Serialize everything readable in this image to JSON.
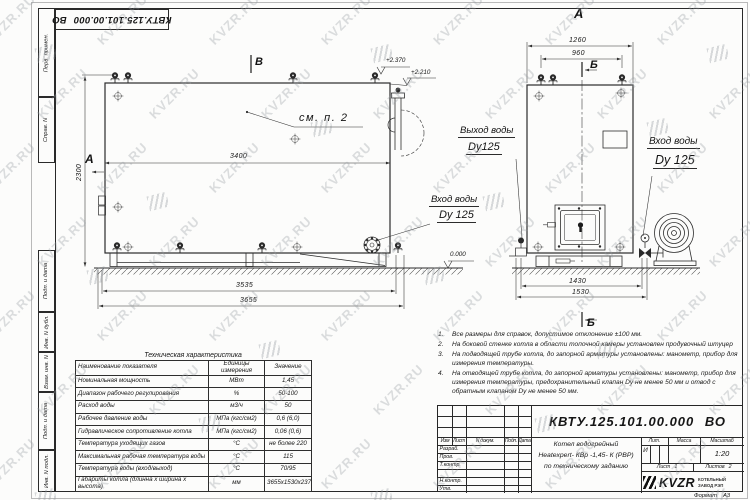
{
  "watermark": {
    "text": "KVZR.RU"
  },
  "stamp_top": {
    "doc_number": "КВТУ.125.101.00.000 ВО"
  },
  "margin_labels": [
    "Перв. примен.",
    "Справ. N",
    "Подп. и дата",
    "Инв. N дубл.",
    "Взам. инв. N",
    "Подп. и дата",
    "Инв. N подл."
  ],
  "side_view": {
    "view_label_top": "В",
    "section_label_left": "А",
    "callout": "см. п. 2",
    "elevation_top": "+2.370",
    "elevation_mid": "+2.210",
    "elevation_zero": "0.000",
    "dim_height": "2300",
    "dim_width_inner": "3400",
    "dim_width_frame": "3535",
    "dim_width_total": "3655",
    "inlet_line1": "Вход воды",
    "inlet_line2": "Dy 125"
  },
  "front_view": {
    "view_label_top": "А",
    "section_label_top": "Б",
    "section_label_bottom": "Б",
    "dim_width_top": "1260",
    "dim_valves": "960",
    "dim_base_inner": "1430",
    "dim_base_total": "1530",
    "outlet_line1": "Выход воды",
    "outlet_line2": "Dy125",
    "inlet_line1": "Вход воды",
    "inlet_line2": "Dy 125"
  },
  "notes": [
    {
      "num": "1.",
      "text": "Все размеры для справок, допустимое отклонение  ±100 мм."
    },
    {
      "num": "2.",
      "text": "На боковой стенке котла в области топочной камеры установлен продувочный штуцер"
    },
    {
      "num": "3.",
      "text": "На  подводящей трубе котла, до запорной арматуры установлены:  манометр, прибор для измерения температуры."
    },
    {
      "num": "4.",
      "text": "На отводящей трубе котла, до запорной арматуры установлены: манометр, прибор для измерения температуры, предохранительный клапан  Dу не менее  50 мм и отвод с обратным клапаном  Dу не менее  50 мм."
    }
  ],
  "tech_table": {
    "title": "Техническая характеристика",
    "headers": {
      "name": "Наименование показателя",
      "units": "Единицы измерения",
      "value": "Значение"
    },
    "rows": [
      {
        "name": "Номинальная мощность",
        "units": "МВт",
        "value": "1,45"
      },
      {
        "name": "Диапазон рабочего регулирования",
        "units": "%",
        "value": "50-100"
      },
      {
        "name": "Расход воды",
        "units": "м3/ч",
        "value": "50"
      },
      {
        "name": "Рабочее давление воды",
        "units": "МПа (кгс/см2)",
        "value": "0,6 (6,0)"
      },
      {
        "name": "Гидравлическое сопротивление котла",
        "units": "МПа (кгс/см2)",
        "value": "0,06 (0,6)"
      },
      {
        "name": "Температура уходящих газов",
        "units": "°С",
        "value": "не более 220"
      },
      {
        "name": "Максимальная рабочая температура воды",
        "units": "°С",
        "value": "115"
      },
      {
        "name": "Температура воды (вход/выход)",
        "units": "°С",
        "value": "70/95"
      },
      {
        "name": "Габариты котла (длинна х ширина х высота)",
        "units": "мм",
        "value": "3655х1530х2370"
      }
    ]
  },
  "title_block": {
    "doc_number": "КВТУ.125.101.00.000 ВО",
    "rev_cols": [
      "Изм",
      "Лист",
      "N докум.",
      "Подп.",
      "Дата"
    ],
    "rev_rows": [
      "Разраб.",
      "Пров.",
      "Т.контр.",
      "Н.контр.",
      "Утв."
    ],
    "description": [
      "Котел водогрейный",
      "Heatexpert- КВр -1,45- К (РВР)",
      "по техническому заданию"
    ],
    "lit_label": "Лит.",
    "lit_value": "И",
    "mass_label": "Масса",
    "scale_label": "Масштаб",
    "scale_value": "1:20",
    "sheet_label": "Лист",
    "sheet_value": "1",
    "sheets_label": "Листов",
    "sheets_value": "2",
    "company": {
      "logo_text": "KVZR",
      "name_line1": "КОТЕЛЬНЫЙ",
      "name_line2": "ЗАВОД РЭП"
    }
  },
  "format_note": {
    "label": "Формат",
    "value": "А3"
  }
}
